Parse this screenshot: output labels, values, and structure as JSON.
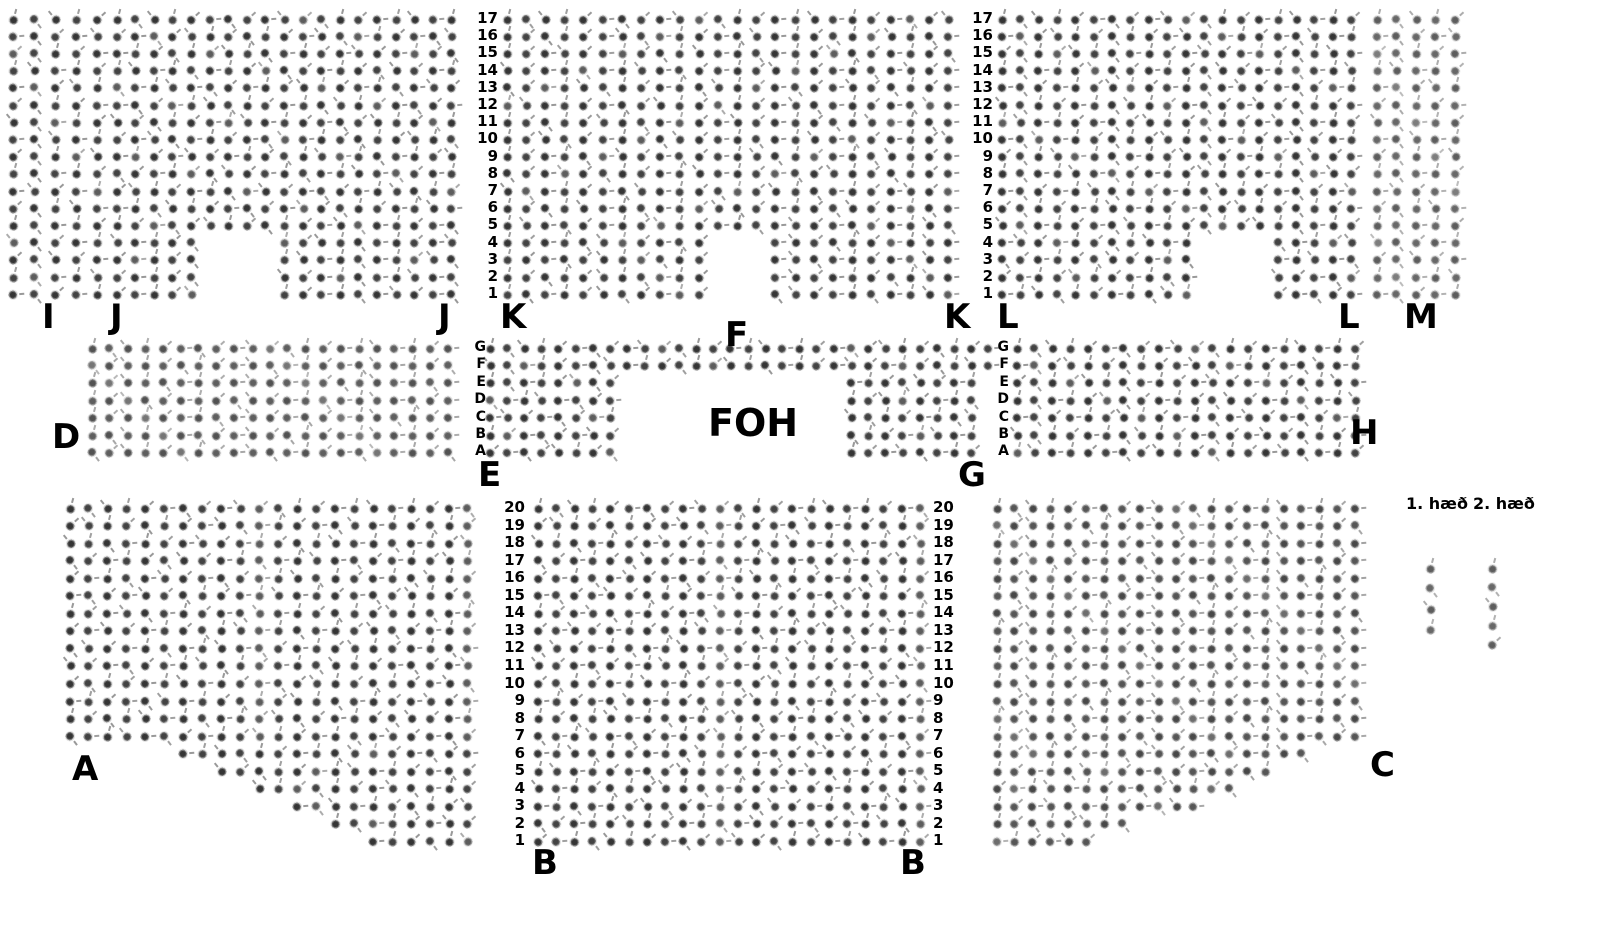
{
  "foh_label": "FOH",
  "legend": {
    "floor1_label": "1. hæð",
    "floor2_label": "2. hæð",
    "floor1_sample_seats": 4,
    "floor2_sample_seats": 5
  },
  "colors": {
    "background": "#ffffff",
    "text": "#000000",
    "seat_dark": "#3a3a3a",
    "seat_ring": "#e3e3e3"
  },
  "sections": [
    {
      "id": "I",
      "pos": {
        "x": 13,
        "y": 19,
        "cw": 21,
        "rh": 17.2
      },
      "rows": [
        [
          17,
          "ooooo"
        ]
      ]
    },
    {
      "id": "J",
      "pos": {
        "x": 117,
        "y": 19,
        "cw": 18.6,
        "rh": 17.2
      },
      "rows": [
        [
          13,
          "ooooooooooooooooooo"
        ],
        [
          4,
          "ooooo....oooooooooo"
        ]
      ]
    },
    {
      "id": "K",
      "pos": {
        "x": 507,
        "y": 19,
        "cw": 19.2,
        "rh": 17.2
      },
      "rows": [
        [
          13,
          "oooooooooooooooooooooooo"
        ],
        [
          4,
          "ooooooooooo...oooooooooo"
        ]
      ]
    },
    {
      "id": "L",
      "pos": {
        "x": 1002,
        "y": 19,
        "cw": 18.4,
        "rh": 17.2
      },
      "rows": [
        [
          13,
          "oooooooooooooooooooo"
        ],
        [
          4,
          "ooooooooooo....ooooo"
        ]
      ]
    },
    {
      "id": "M",
      "pos": {
        "x": 1377,
        "y": 19,
        "cw": 19.5,
        "rh": 17.2
      },
      "tone": 0.8,
      "rows": [
        [
          17,
          "ooooo"
        ]
      ]
    },
    {
      "id": "D",
      "pos": {
        "x": 92,
        "y": 348,
        "cw": 17.8,
        "rh": 17.4
      },
      "tone": 0.85,
      "rows": [
        [
          7,
          "ooooooooooooooooooooo"
        ]
      ]
    },
    {
      "id": "EFG",
      "pos": {
        "x": 490,
        "y": 348,
        "cw": 17.2,
        "rh": 17.4
      },
      "rows": [
        [
          2,
          "oooooooooooooooooooooooooooooo"
        ],
        [
          5,
          "oooooooo.............oooooooo."
        ]
      ]
    },
    {
      "id": "H",
      "pos": {
        "x": 1017,
        "y": 348,
        "cw": 17.8,
        "rh": 17.4
      },
      "rows": [
        [
          7,
          "oooooooooooooooooooo"
        ]
      ]
    },
    {
      "id": "A",
      "pos": {
        "x": 70,
        "y": 508,
        "cw": 18.95,
        "rh": 17.55
      },
      "rows": [
        [
          14,
          "oooooooooooooooooooooo"
        ],
        [
          1,
          "......oooooooooooooooo"
        ],
        [
          1,
          "........oooooooooooooo"
        ],
        [
          1,
          "..........oooooooooooo"
        ],
        [
          1,
          "............oooooooooo"
        ],
        [
          1,
          "..............oooooooo"
        ],
        [
          1,
          "................oooooo"
        ]
      ]
    },
    {
      "id": "B",
      "pos": {
        "x": 538,
        "y": 508,
        "cw": 18.2,
        "rh": 17.55
      },
      "rows": [
        [
          20,
          "oooooooooooooooooooooo"
        ]
      ]
    },
    {
      "id": "C",
      "pos": {
        "x": 997,
        "y": 508,
        "cw": 17.9,
        "rh": 17.55
      },
      "tone": 0.9,
      "rows": [
        [
          14,
          "ooooooooooooooooooooo"
        ],
        [
          1,
          "oooooooooooooooooo..."
        ],
        [
          1,
          "oooooooooooooooo....."
        ],
        [
          1,
          "oooooooooooooo......."
        ],
        [
          1,
          "oooooooooooo........."
        ],
        [
          1,
          "oooooooo............."
        ],
        [
          1,
          "oooooo..............."
        ]
      ]
    },
    {
      "id": "LEGEND1",
      "pos": {
        "x": 1430,
        "y": 568,
        "cw": 20,
        "rh": 20.5
      },
      "tone": 0.8,
      "rows": [
        [
          4,
          "o"
        ]
      ]
    },
    {
      "id": "LEGEND2",
      "pos": {
        "x": 1492,
        "y": 568,
        "cw": 20,
        "rh": 19
      },
      "tone": 0.8,
      "rows": [
        [
          5,
          "o"
        ]
      ]
    }
  ],
  "guides": [
    {
      "id": "rows-top-left",
      "x": 498,
      "y": 19,
      "rh": 17.2,
      "fs": 15,
      "align": "right",
      "labels": [
        "17",
        "16",
        "15",
        "14",
        "13",
        "12",
        "11",
        "10",
        "9",
        "8",
        "7",
        "6",
        "5",
        "4",
        "3",
        "2",
        "1"
      ]
    },
    {
      "id": "rows-top-right",
      "x": 993,
      "y": 19,
      "rh": 17.2,
      "fs": 15,
      "align": "right",
      "labels": [
        "17",
        "16",
        "15",
        "14",
        "13",
        "12",
        "11",
        "10",
        "9",
        "8",
        "7",
        "6",
        "5",
        "4",
        "3",
        "2",
        "1"
      ]
    },
    {
      "id": "rows-mid-left",
      "x": 486,
      "y": 348,
      "rh": 17.4,
      "fs": 14,
      "align": "right",
      "labels": [
        "G",
        "F",
        "E",
        "D",
        "C",
        "B",
        "A"
      ]
    },
    {
      "id": "rows-mid-right",
      "x": 1009,
      "y": 348,
      "rh": 17.4,
      "fs": 14,
      "align": "right",
      "labels": [
        "G",
        "F",
        "E",
        "D",
        "C",
        "B",
        "A"
      ]
    },
    {
      "id": "rows-bottom-left",
      "x": 525,
      "y": 508,
      "rh": 17.55,
      "fs": 15,
      "align": "right",
      "labels": [
        "20",
        "19",
        "18",
        "17",
        "16",
        "15",
        "14",
        "13",
        "12",
        "11",
        "10",
        "9",
        "8",
        "7",
        "6",
        "5",
        "4",
        "3",
        "2",
        "1"
      ]
    },
    {
      "id": "rows-bottom-right",
      "x": 933,
      "y": 508,
      "rh": 17.55,
      "fs": 15,
      "align": "left",
      "labels": [
        "20",
        "19",
        "18",
        "17",
        "16",
        "15",
        "14",
        "13",
        "12",
        "11",
        "10",
        "9",
        "8",
        "7",
        "6",
        "5",
        "4",
        "3",
        "2",
        "1"
      ]
    }
  ],
  "section_labels": [
    {
      "text": "I",
      "x": 42,
      "y": 300
    },
    {
      "text": "J",
      "x": 110,
      "y": 300
    },
    {
      "text": "J",
      "x": 438,
      "y": 300
    },
    {
      "text": "K",
      "x": 500,
      "y": 300
    },
    {
      "text": "F",
      "x": 725,
      "y": 318
    },
    {
      "text": "K",
      "x": 944,
      "y": 300
    },
    {
      "text": "L",
      "x": 997,
      "y": 300
    },
    {
      "text": "L",
      "x": 1338,
      "y": 300
    },
    {
      "text": "M",
      "x": 1404,
      "y": 300
    },
    {
      "text": "D",
      "x": 52,
      "y": 420
    },
    {
      "text": "H",
      "x": 1350,
      "y": 416
    },
    {
      "text": "E",
      "x": 478,
      "y": 458
    },
    {
      "text": "G",
      "x": 958,
      "y": 458
    },
    {
      "text": "A",
      "x": 72,
      "y": 752
    },
    {
      "text": "C",
      "x": 1370,
      "y": 748
    },
    {
      "text": "B",
      "x": 532,
      "y": 846
    },
    {
      "text": "B",
      "x": 900,
      "y": 846
    }
  ]
}
